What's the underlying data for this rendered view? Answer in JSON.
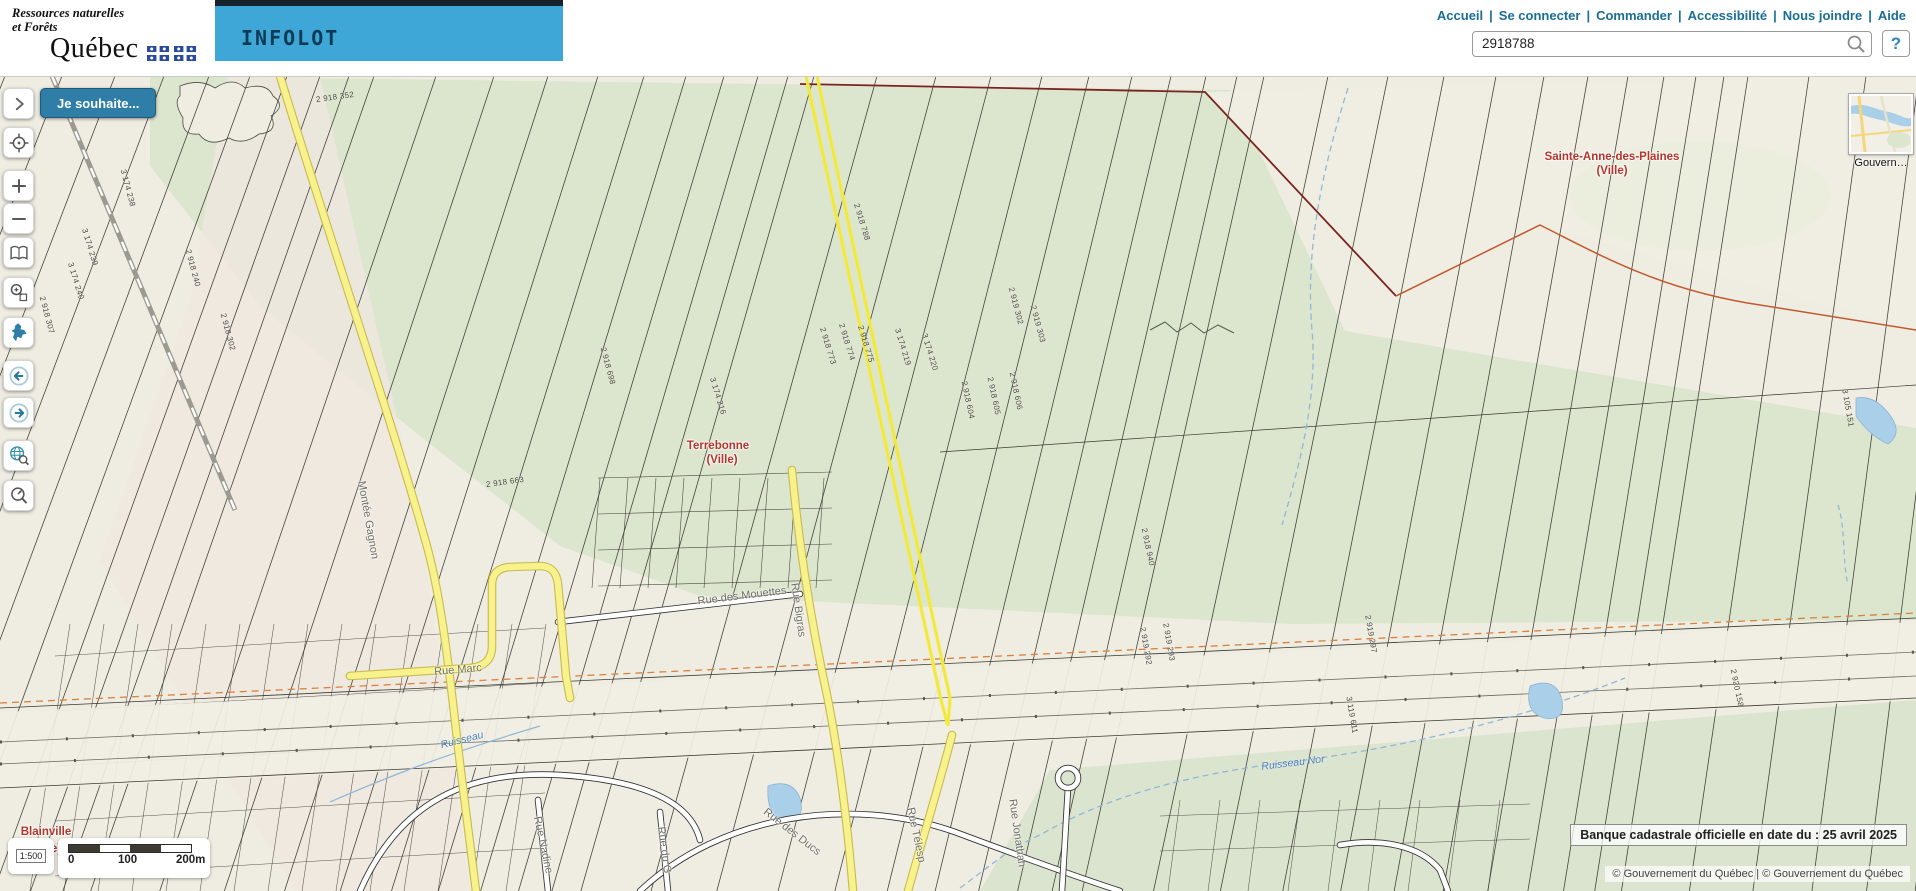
{
  "header": {
    "department": {
      "line1": "Ressources naturelles",
      "line2": "et Forêts",
      "wordmark": "Québec"
    },
    "app_title": "INFOLOT",
    "nav_links": [
      "Accueil",
      "Se connecter",
      "Commander",
      "Accessibilité",
      "Nous joindre",
      "Aide"
    ],
    "search": {
      "value": "2918788",
      "help_label": "?"
    }
  },
  "toolbar": {
    "buttons": [
      {
        "name": "panel-expand-button",
        "icon": "chevron-right-icon"
      },
      {
        "name": "locate-button",
        "icon": "crosshair-icon"
      },
      {
        "name": "zoom-in-button",
        "icon": "plus-icon"
      },
      {
        "name": "zoom-out-button",
        "icon": "minus-icon"
      },
      {
        "name": "legend-button",
        "icon": "book-icon"
      },
      {
        "name": "zoom-window-button",
        "icon": "zoom-window-icon"
      },
      {
        "name": "quebec-extent-button",
        "icon": "quebec-icon"
      },
      {
        "name": "previous-view-button",
        "icon": "arrow-left-circle-icon"
      },
      {
        "name": "next-view-button",
        "icon": "arrow-right-circle-icon"
      },
      {
        "name": "global-search-button",
        "icon": "globe-search-icon"
      },
      {
        "name": "zoom-scale-button",
        "icon": "zoom-scale-icon"
      }
    ]
  },
  "map": {
    "action_button": "Je souhaite...",
    "labels": {
      "cities": [
        {
          "text": "Sainte-Anne-des-Plaines",
          "x": 1612,
          "y": 81
        },
        {
          "text": "(Ville)",
          "x": 1612,
          "y": 95
        },
        {
          "text": "Terrebonne",
          "x": 718,
          "y": 370
        },
        {
          "text": "(Ville)",
          "x": 722,
          "y": 384
        },
        {
          "text": "Blainville",
          "x": 46,
          "y": 756
        },
        {
          "text": "e)",
          "x": 56,
          "y": 773
        }
      ],
      "streets": [
        {
          "text": "Montée Gagnon",
          "x": 368,
          "y": 444,
          "rot": 80
        },
        {
          "text": "Rue Marc",
          "x": 458,
          "y": 594,
          "rot": -5
        },
        {
          "text": "Rue des Mouettes",
          "x": 742,
          "y": 520,
          "rot": -7
        },
        {
          "text": "Rue Bigras",
          "x": 798,
          "y": 534,
          "rot": 82
        },
        {
          "text": "Rue Nadine",
          "x": 543,
          "y": 769,
          "rot": 78
        },
        {
          "text": "Rue du G",
          "x": 664,
          "y": 774,
          "rot": 82
        },
        {
          "text": "Rue des Ducs",
          "x": 792,
          "y": 756,
          "rot": 38
        },
        {
          "text": "Rue Télesp",
          "x": 916,
          "y": 759,
          "rot": 78
        },
        {
          "text": "Rue Jonathan",
          "x": 1017,
          "y": 757,
          "rot": 82
        }
      ],
      "water": [
        {
          "text": "Ruisseau Nor",
          "x": 1293,
          "y": 687,
          "rot": -7
        },
        {
          "text": "Ruisseau",
          "x": 462,
          "y": 664,
          "rot": -14
        }
      ],
      "lots": [
        {
          "text": "2 918 352",
          "x": 335,
          "y": 21,
          "rot": -8
        },
        {
          "text": "2 918 307",
          "x": 47,
          "y": 239,
          "rot": 75
        },
        {
          "text": "3 174 238",
          "x": 128,
          "y": 112,
          "rot": 75
        },
        {
          "text": "3 174 239",
          "x": 90,
          "y": 171,
          "rot": 73
        },
        {
          "text": "3 174 240",
          "x": 76,
          "y": 205,
          "rot": 73
        },
        {
          "text": "2 918 240",
          "x": 193,
          "y": 192,
          "rot": 75
        },
        {
          "text": "2 918 302",
          "x": 228,
          "y": 256,
          "rot": 75
        },
        {
          "text": "2 918 698",
          "x": 608,
          "y": 290,
          "rot": 75
        },
        {
          "text": "3 174 216",
          "x": 718,
          "y": 320,
          "rot": 73
        },
        {
          "text": "2 918 663",
          "x": 505,
          "y": 406,
          "rot": -8
        },
        {
          "text": "2 918 773",
          "x": 828,
          "y": 270,
          "rot": 73
        },
        {
          "text": "2 918 774",
          "x": 847,
          "y": 266,
          "rot": 73
        },
        {
          "text": "2 918 775",
          "x": 866,
          "y": 268,
          "rot": 73
        },
        {
          "text": "3 174 219",
          "x": 903,
          "y": 271,
          "rot": 73
        },
        {
          "text": "3 174 220",
          "x": 930,
          "y": 276,
          "rot": 73
        },
        {
          "text": "2 918 788",
          "x": 862,
          "y": 146,
          "rot": 73
        },
        {
          "text": "2 918 604",
          "x": 968,
          "y": 324,
          "rot": 78
        },
        {
          "text": "2 918 605",
          "x": 994,
          "y": 320,
          "rot": 78
        },
        {
          "text": "2 918 606",
          "x": 1016,
          "y": 315,
          "rot": 78
        },
        {
          "text": "2 919 302",
          "x": 1016,
          "y": 230,
          "rot": 75
        },
        {
          "text": "2 919 303",
          "x": 1038,
          "y": 248,
          "rot": 75
        },
        {
          "text": "2 918 940",
          "x": 1148,
          "y": 471,
          "rot": 78
        },
        {
          "text": "2 919 292",
          "x": 1146,
          "y": 570,
          "rot": 80
        },
        {
          "text": "2 919 293",
          "x": 1169,
          "y": 566,
          "rot": 80
        },
        {
          "text": "2 919 297",
          "x": 1371,
          "y": 558,
          "rot": 80
        },
        {
          "text": "3 119 611",
          "x": 1352,
          "y": 639,
          "rot": 80
        },
        {
          "text": "2 920 158",
          "x": 1737,
          "y": 612,
          "rot": 78
        },
        {
          "text": "3 105 151",
          "x": 1848,
          "y": 332,
          "rot": 80
        }
      ]
    },
    "scale_bar": {
      "ratio": "1:500",
      "ticks": [
        "0",
        "100",
        "200m"
      ]
    },
    "overview_attribution": "Gouvern…",
    "date_banner": "Banque cadastrale officielle en date du : 25 avril 2025",
    "copyright": "© Gouvernement du Québec | © Gouvernement du Québec",
    "colors": {
      "banner_cyan": "#3FA6D8",
      "link_blue": "#1A6E96",
      "highlight_yellow": "#F3EB3C",
      "city_label_red": "#B5342A",
      "road_yellow": "#F8F28C"
    }
  }
}
